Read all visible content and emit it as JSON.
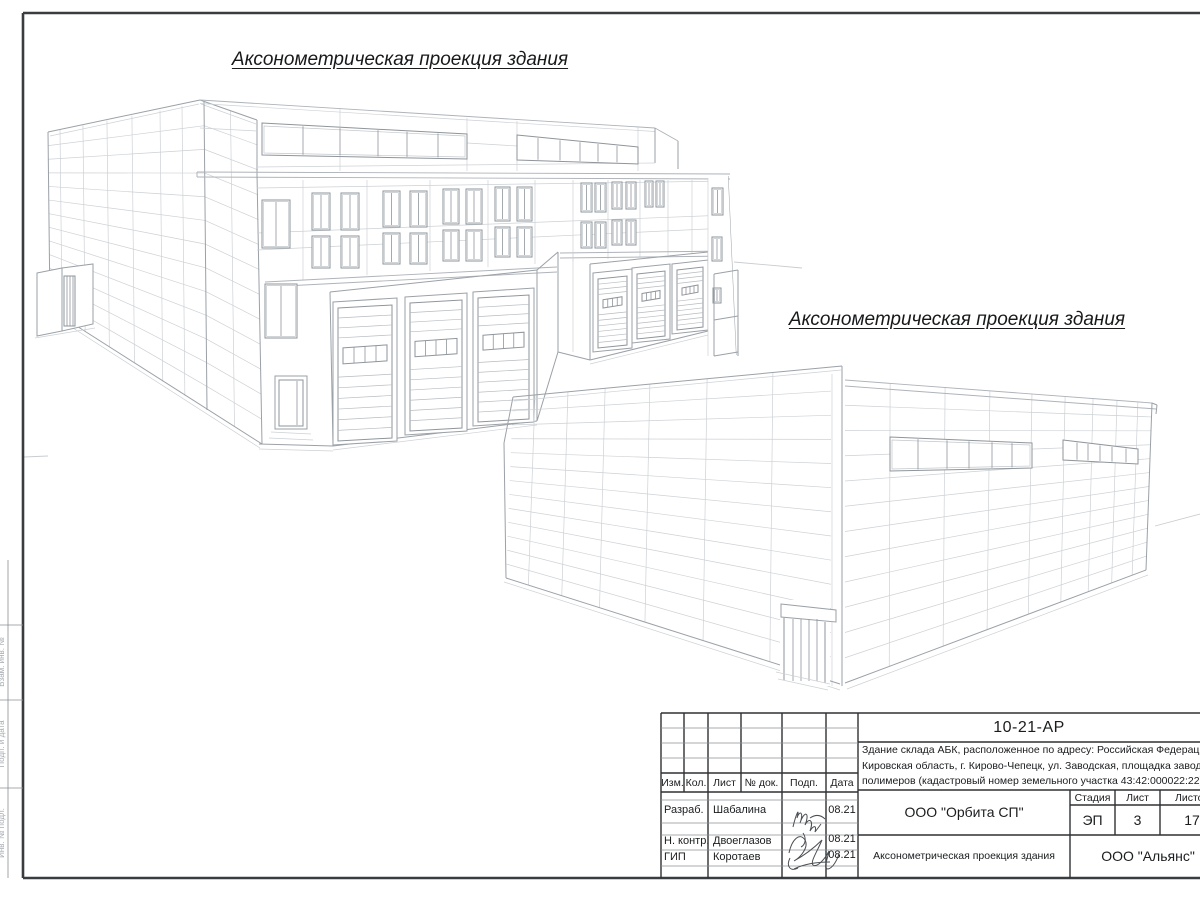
{
  "views": {
    "view1_title": "Аксонометрическая проекция здания",
    "view2_title": "Аксонометрическая проекция здания"
  },
  "title_block": {
    "doc_number": "10-21-АР",
    "description_lines": [
      "Здание склада АБК, расположенное по адресу: Российская Федерация,",
      "Кировская область, г. Кирово-Чепецк, ул. Заводская, площадка завода",
      "полимеров (кадастровый номер земельного участка 43:42:000022:22)"
    ],
    "columns": {
      "izm": "Изм.",
      "kol": "Кол.",
      "list": "Лист",
      "doc": "№ док.",
      "podp": "Подп.",
      "data": "Дата"
    },
    "rows": [
      {
        "role": "Разраб.",
        "name": "Шабалина",
        "date": "08.21"
      },
      {
        "role": "Н. контр.",
        "name": "Двоеглазов",
        "date": "08.21"
      },
      {
        "role": "ГИП",
        "name": "Коротаев",
        "date": "08.21"
      }
    ],
    "developer": "ООО \"Орбита СП\"",
    "stage_label": "Стадия",
    "sheet_label": "Лист",
    "sheets_label": "Листов",
    "stage": "ЭП",
    "sheet_no": "3",
    "sheets_total": "17",
    "drawing_title": "Аксонометрическая проекция здания",
    "company": "ООО \"Альянс\""
  },
  "frame": {
    "side_labels": [
      "Взам. инв. №",
      "Подп. и дата",
      "Инв. № подл."
    ]
  }
}
